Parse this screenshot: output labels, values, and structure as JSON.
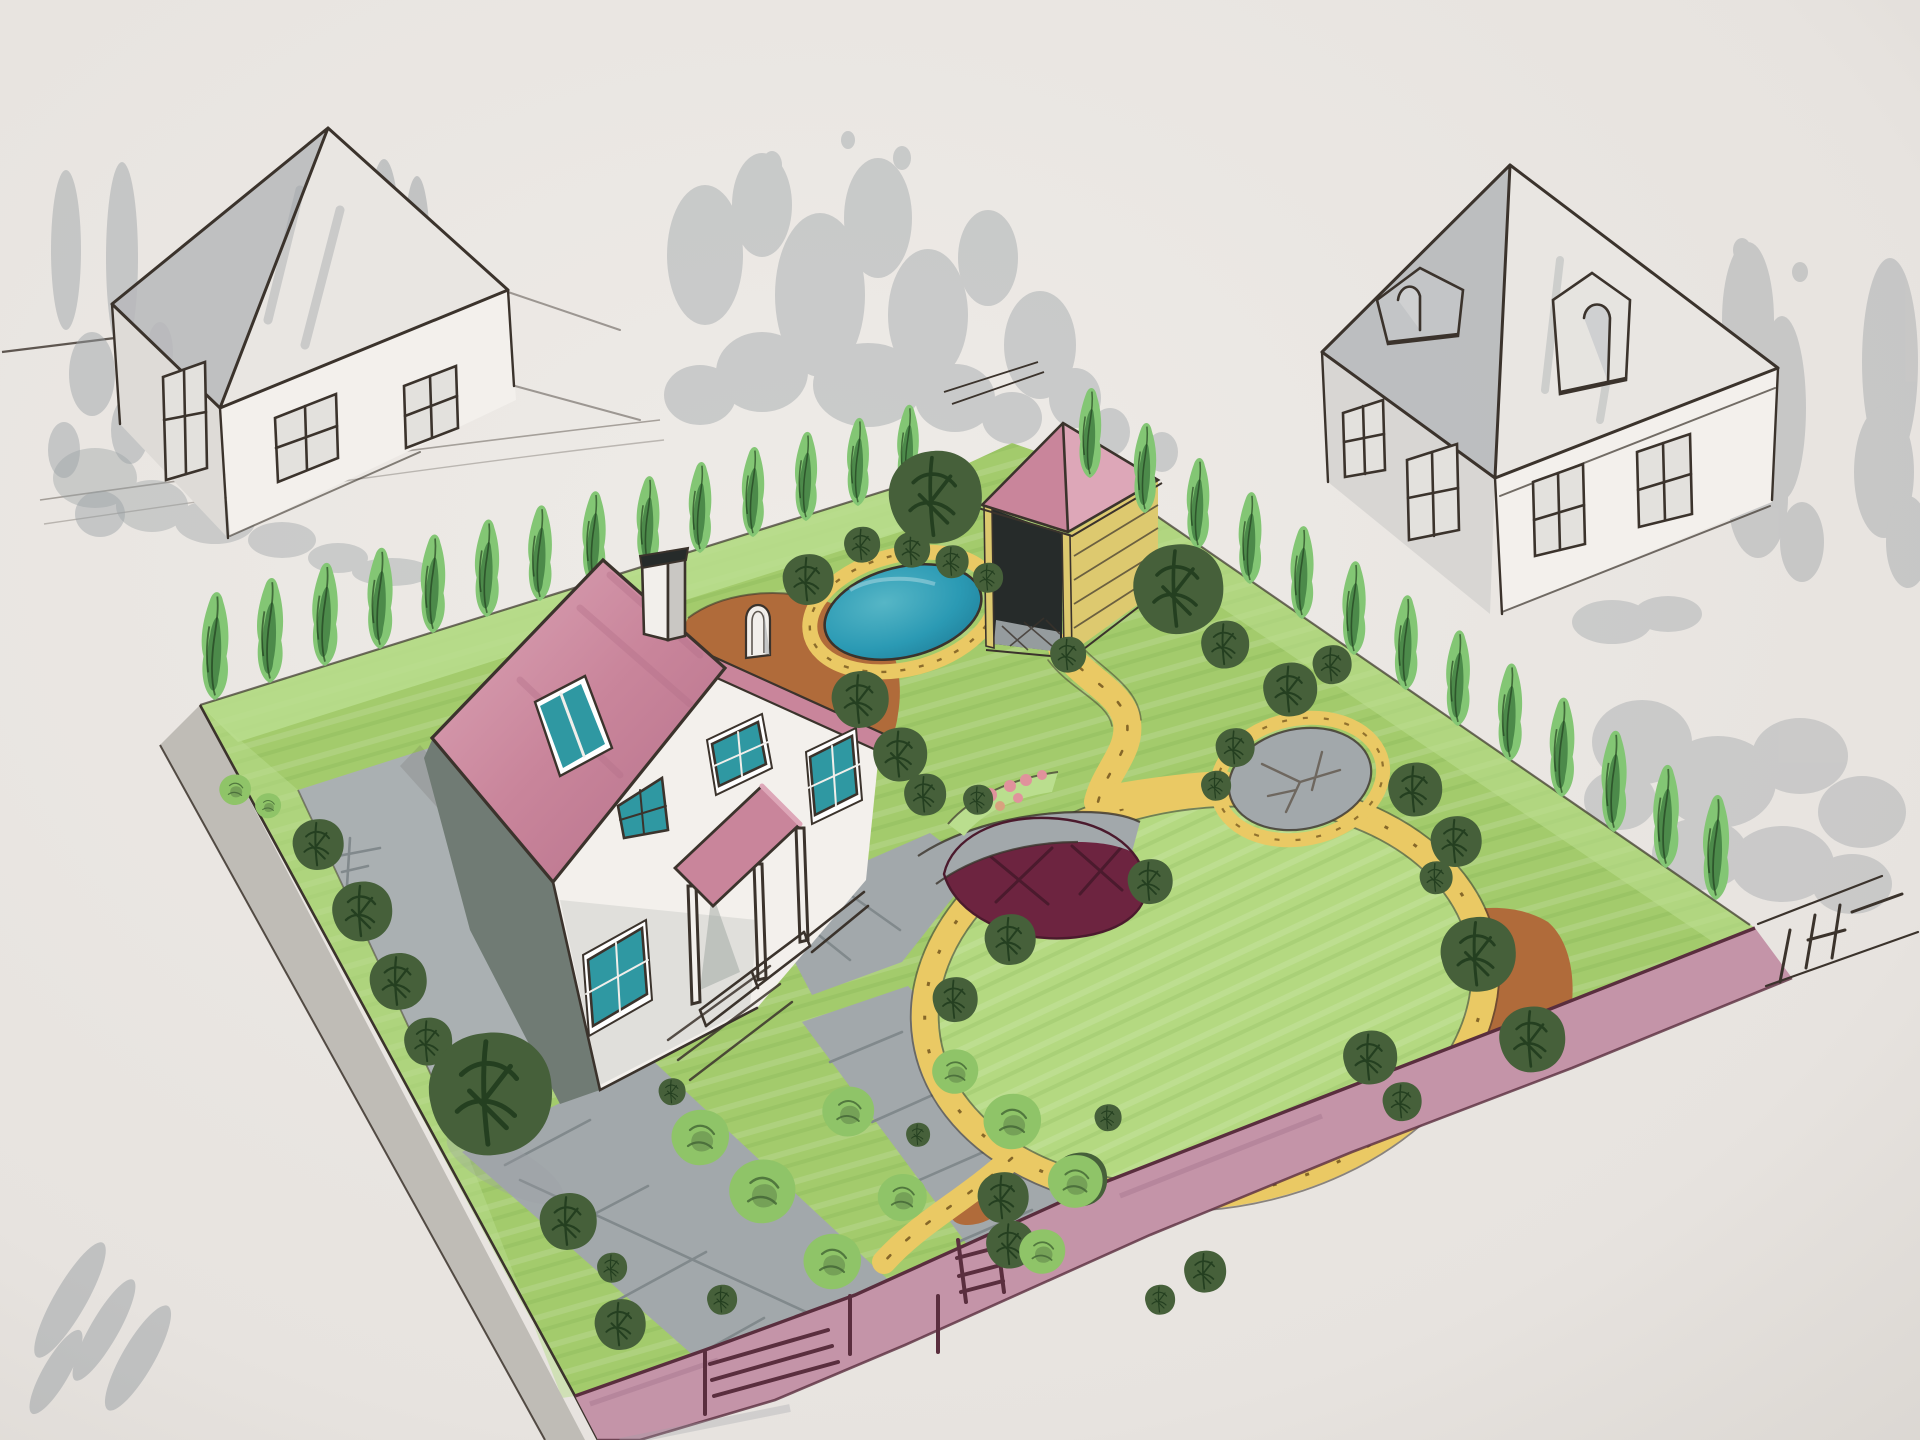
{
  "scene": {
    "type": "hand-drawn landscape design sketch, marker and ink, aerial perspective",
    "subject": "fenced garden plot with cottage, gazebo, pond, lawns and paths, between two pen-sketched neighbor houses",
    "elements": [
      {
        "name": "paper",
        "desc": "warm grey drawing paper background"
      },
      {
        "name": "left-neighbor-house",
        "desc": "uncolored ink sketch, pyramid roof shaded grey, cross windows"
      },
      {
        "name": "right-neighbor-house",
        "desc": "uncolored ink sketch, gable roof with two attic dormers, cross windows"
      },
      {
        "name": "grey-marker-trees",
        "desc": "loose grey marker blobs suggesting background trees around both sketched houses"
      },
      {
        "name": "main-house",
        "desc": "white cottage with pink gable roof, teal skylight and windows, white chimney, pink-roofed porch"
      },
      {
        "name": "gazebo",
        "desc": "pink pyramid roof, yellow posts and slat wall, dark interior, grey paved floor"
      },
      {
        "name": "pond",
        "desc": "teal-blue oval pond with yellow stone rim"
      },
      {
        "name": "stone-patio",
        "desc": "grey round paved circle with yellow stone rim"
      },
      {
        "name": "root-cellar-mound",
        "desc": "dark maroon half-dome with ink cross-hatch and grey edging path"
      },
      {
        "name": "lawn-circle",
        "desc": "large circular lawn ringed by a yellow pebble path"
      },
      {
        "name": "yellow-paths",
        "desc": "winding yellow gravel paths with ink pebble dots linking gazebo, patio and lawn circle"
      },
      {
        "name": "mulch-beds",
        "desc": "terracotta brown planting beds behind house and along right fence"
      },
      {
        "name": "cypress-hedges",
        "desc": "rows of narrow green conifers along the two rear borders"
      },
      {
        "name": "round-trees",
        "desc": "dark green round trees and light green shrubs scattered over the plot"
      },
      {
        "name": "flower-bed",
        "desc": "small bed with pink flower dots near the lawn circle"
      },
      {
        "name": "driveway",
        "desc": "grey paved driveway strips with ink slab joints leading to the front gate"
      },
      {
        "name": "fence",
        "desc": "mauve-pink front fence wall with ink gate bars and a small ladder sketch"
      },
      {
        "name": "sidewalk",
        "desc": "grey sidewalk band along the left border"
      },
      {
        "name": "corner-survey-marks",
        "desc": "ink hatch marks and extension lines beyond the right fence corner"
      }
    ],
    "visible_text": []
  },
  "palette": {
    "paper": "#eae6e2",
    "paperEdge": "#d8d4cf",
    "pen": "#3b332c",
    "penSoft": "#6e675f",
    "greyMarker": "#9aa0a4",
    "lawn": "#a3cb6c",
    "lawnLight": "#bade8e",
    "lawnCircle": "#b4d981",
    "cypLight": "#83c674",
    "cypDark": "#3f7a40",
    "treeDark": "#46603a",
    "treeLine": "#1f3a1c",
    "shrubLight": "#8fc468",
    "roofPink": "#c9859b",
    "roofPinkLight": "#dda7b8",
    "roofPinkDark": "#b5708a",
    "fencePink": "#c494a8",
    "fenceDark": "#5a2e3e",
    "pathYellow": "#eac964",
    "pathEdge": "#7a5c22",
    "brown": "#b06b3a",
    "pondBlue": "#2b9ab4",
    "pondDeep": "#1f7e98",
    "glass": "#2f98a2",
    "pave": "#a2a8ab",
    "paveDark": "#81898c",
    "wallShadow": "#707b74",
    "maroon": "#6d2440",
    "maroonDark": "#4b1a2d",
    "gazeboYellow": "#ddc96f",
    "gazeboDark": "#262b2a",
    "houseWhite": "#f3f0ec",
    "flowerPink": "#e0929c"
  }
}
